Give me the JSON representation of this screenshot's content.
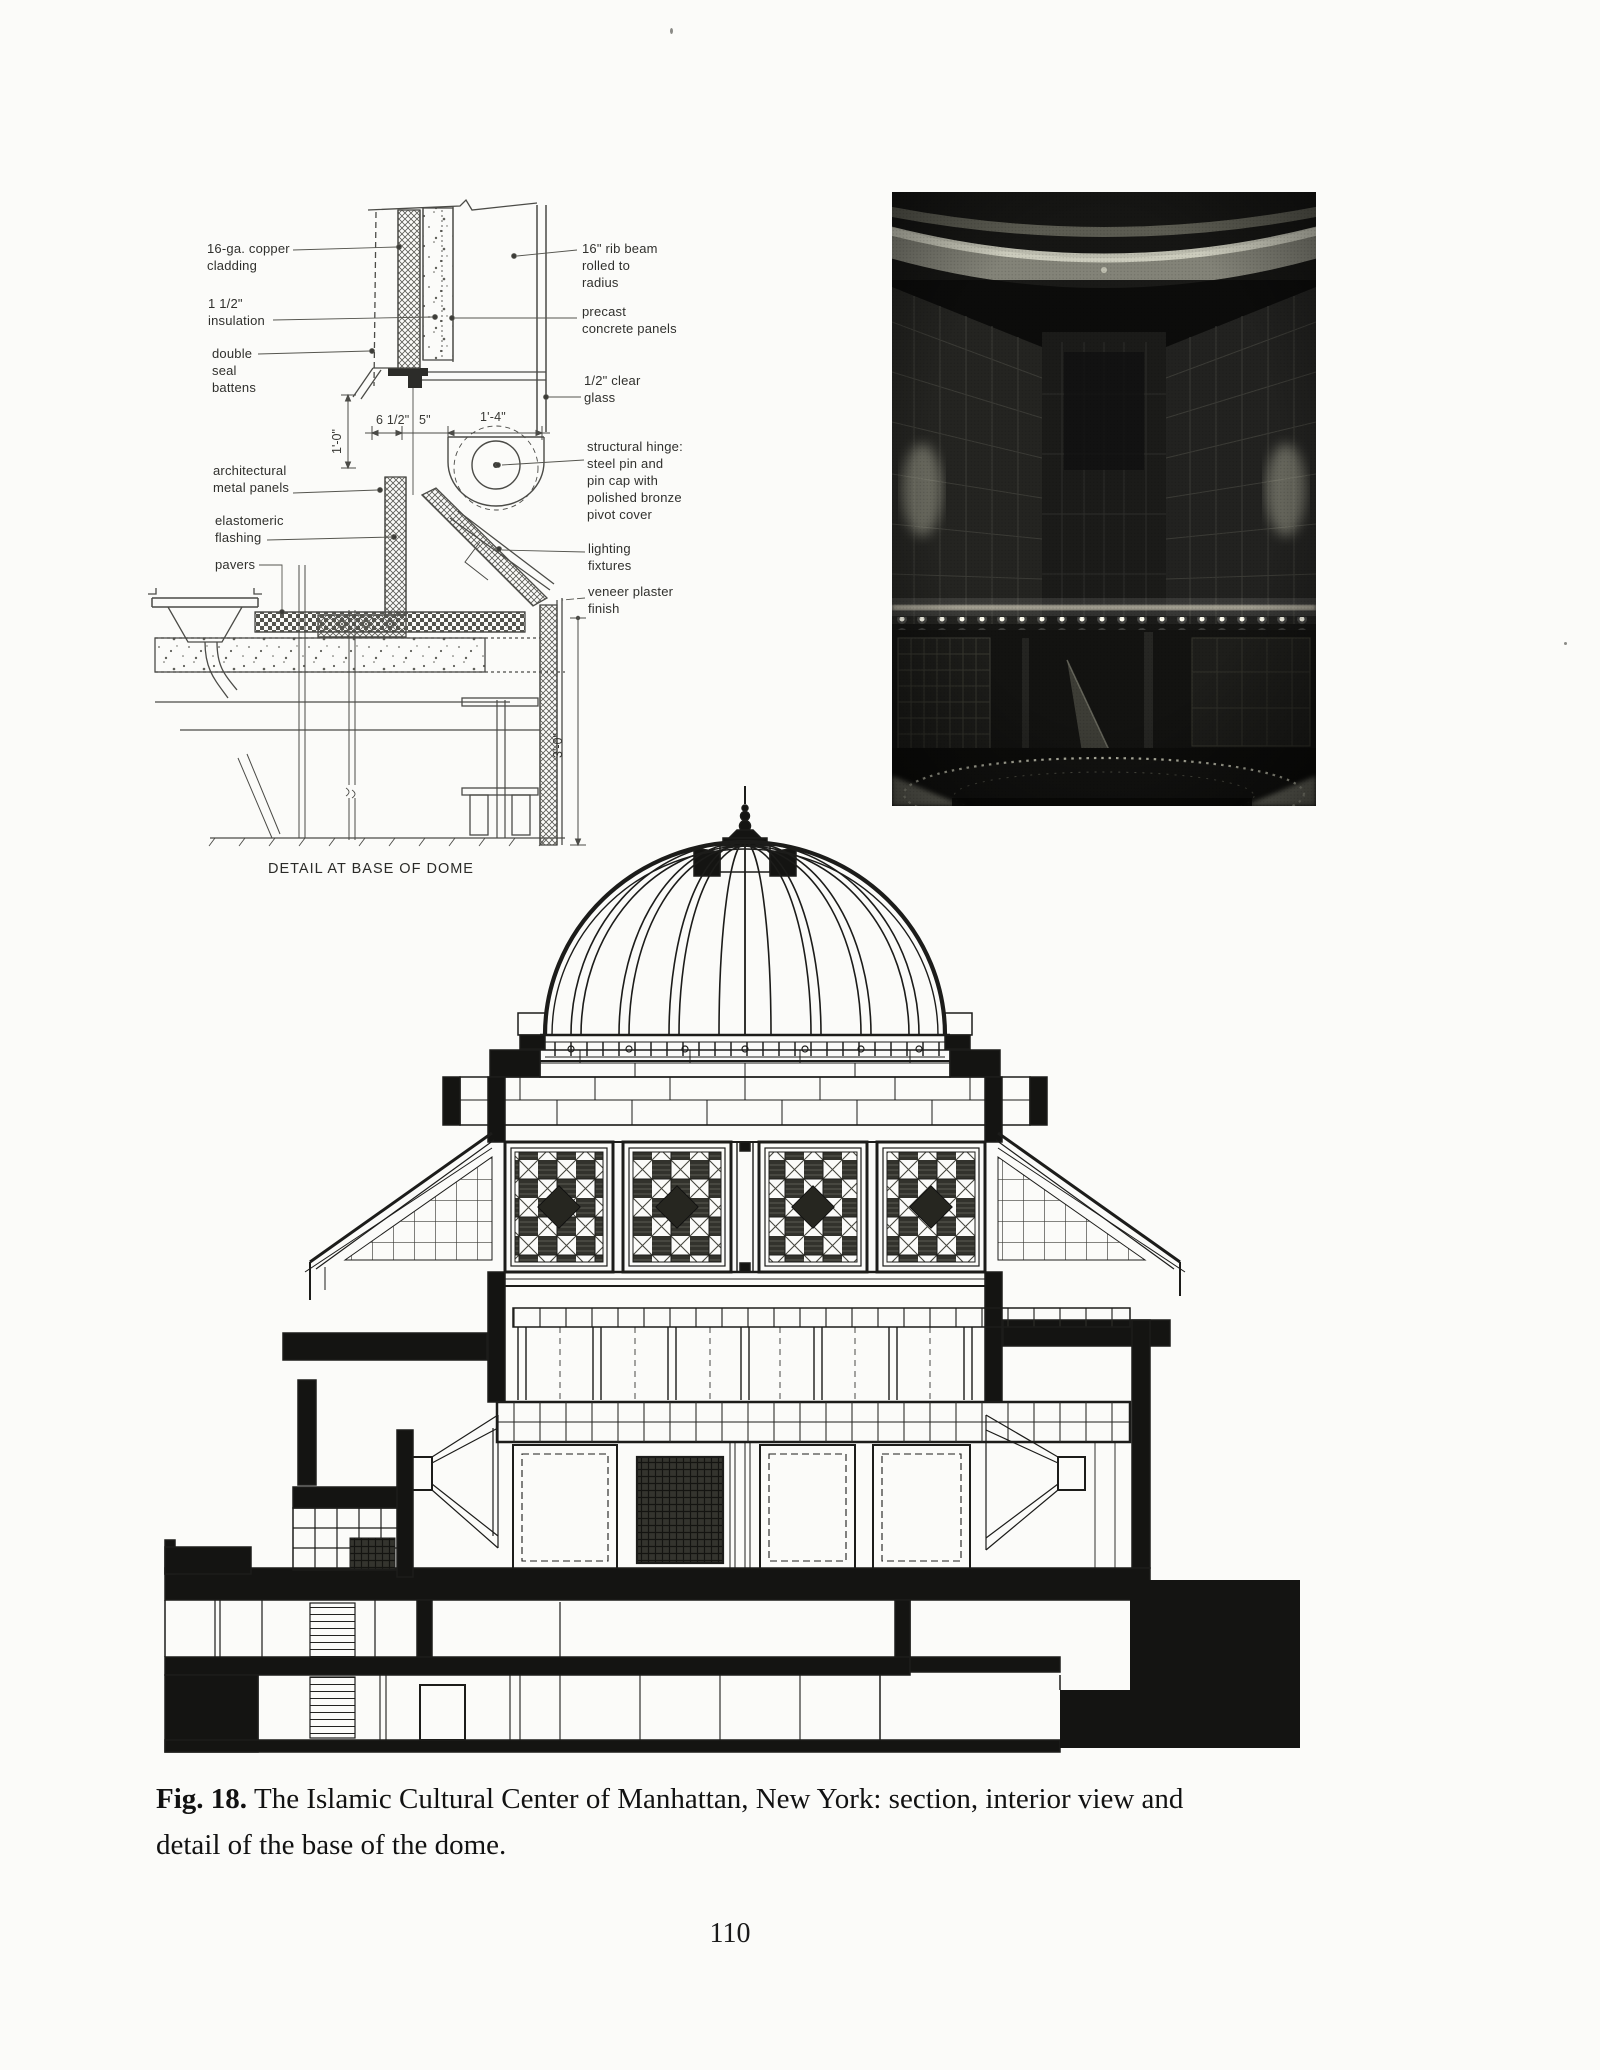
{
  "page": {
    "number": "110",
    "paper_color": "#fbfbf9",
    "ink_color": "#1f1f1f"
  },
  "figure": {
    "caption_bold": "Fig. 18.",
    "caption_line1": "The Islamic Cultural Center of Manhattan, New York: section, interior view and",
    "caption_line2": "detail of the base of the dome."
  },
  "detail": {
    "title": "DETAIL AT BASE OF DOME",
    "labels": {
      "copper": [
        "16-ga. copper",
        "cladding"
      ],
      "insulation": [
        "1 1/2\"",
        "insulation"
      ],
      "battens": [
        "double",
        "seal",
        "battens"
      ],
      "metal": [
        "architectural",
        "metal panels"
      ],
      "flashing": [
        "elastomeric",
        "flashing"
      ],
      "pavers": [
        "pavers"
      ],
      "ribbeam": [
        "16\" rib beam",
        "rolled to",
        "radius"
      ],
      "precast": [
        "precast",
        "concrete panels"
      ],
      "glass": [
        "1/2\" clear",
        "glass"
      ],
      "hinge": [
        "structural hinge:",
        "steel pin and",
        "pin cap with",
        "polished bronze",
        "pivot cover"
      ],
      "lighting": [
        "lighting",
        "fixtures"
      ],
      "plaster": [
        "veneer plaster",
        "finish"
      ]
    },
    "dims": {
      "d1": "1'-0\"",
      "d2": "6 1/2\"",
      "d3": "5\"",
      "d4": "1'-4\"",
      "d5": "3'-0\""
    }
  }
}
